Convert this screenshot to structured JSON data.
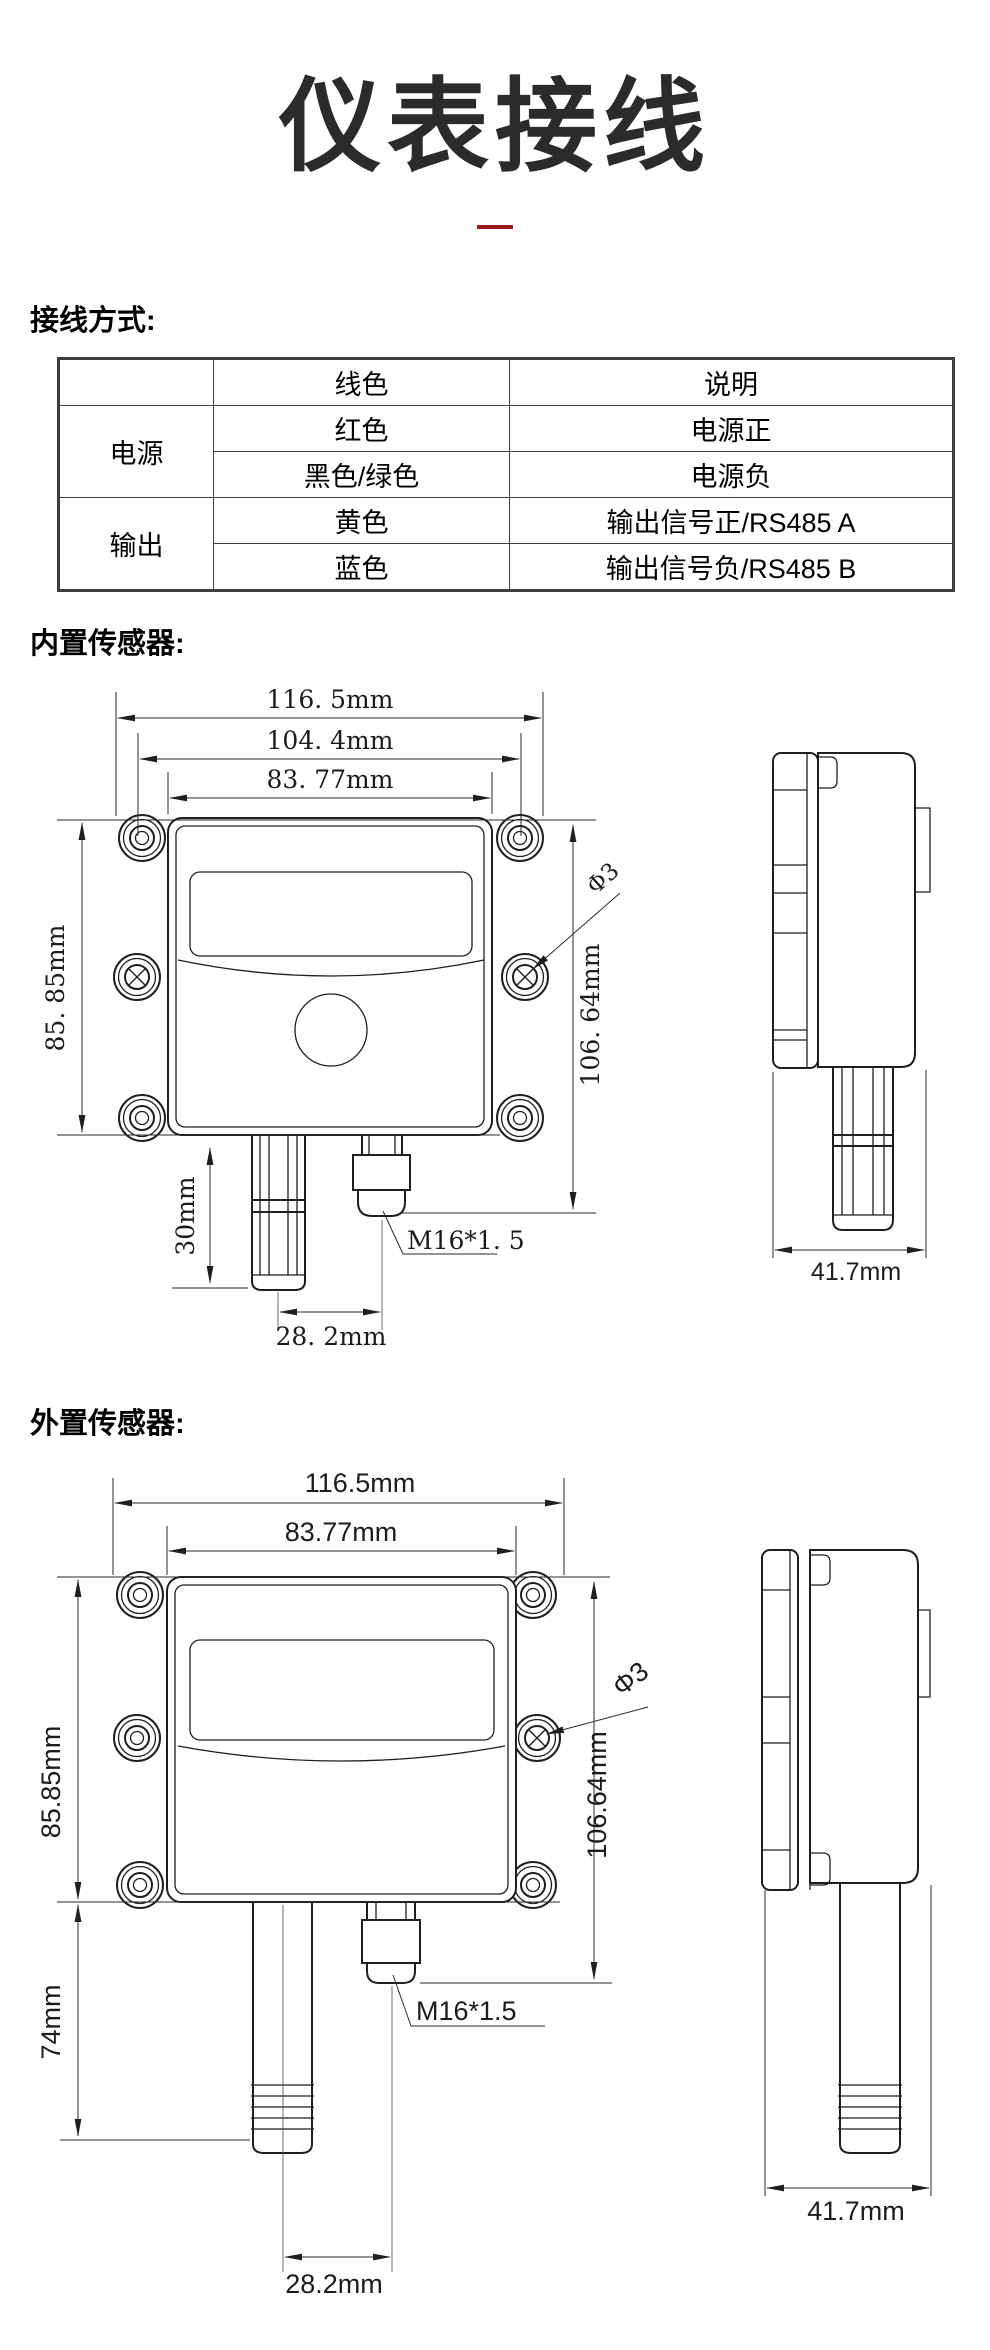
{
  "page": {
    "title": "仪表接线",
    "accent_color": "#9b1b1b"
  },
  "wiring": {
    "heading": "接线方式:",
    "table": {
      "headers": {
        "color": "线色",
        "desc": "说明"
      },
      "groups": [
        {
          "label": "电源",
          "rows": [
            [
              "红色",
              "电源正"
            ],
            [
              "黑色/绿色",
              "电源负"
            ]
          ]
        },
        {
          "label": "输出",
          "rows": [
            [
              "黄色",
              "输出信号正/RS485 A"
            ],
            [
              "蓝色",
              "输出信号负/RS485 B"
            ]
          ]
        }
      ]
    }
  },
  "builtin": {
    "heading": "内置传感器:",
    "dims": {
      "width_overall": "116. 5mm",
      "width_holes": "104. 4mm",
      "width_body": "83. 77mm",
      "height_body": "85. 85mm",
      "height_overall": "106. 64mm",
      "probe_length": "30mm",
      "probe_offset": "28. 2mm",
      "gland_thread": "M16*1. 5",
      "hole_diameter": "Φ3",
      "side_depth": "41.7mm"
    }
  },
  "external": {
    "heading": "外置传感器:",
    "dims": {
      "width_overall": "116.5mm",
      "width_body": "83.77mm",
      "height_body": "85.85mm",
      "height_overall": "106.64mm",
      "probe_length": "74mm",
      "probe_offset": "28.2mm",
      "gland_thread": "M16*1.5",
      "hole_diameter": "Φ3",
      "side_depth": "41.7mm"
    }
  }
}
